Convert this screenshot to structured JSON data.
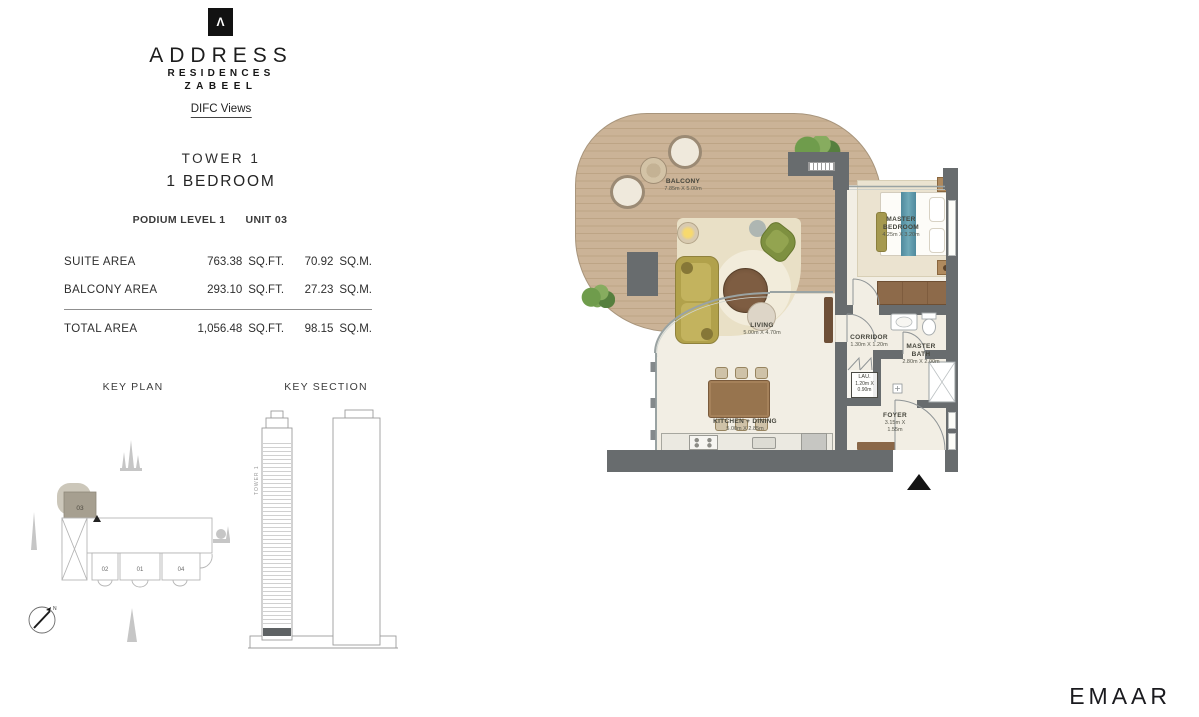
{
  "brand": {
    "logo_mark_glyph": "Λ",
    "name": "ADDRESS",
    "sub_name": "RESIDENCES",
    "location": "ZABEEL",
    "view_tag": "DIFC Views"
  },
  "unit": {
    "tower": "TOWER 1",
    "bedrooms": "1 BEDROOM",
    "level": "PODIUM LEVEL 1",
    "unit_no": "UNIT 03"
  },
  "area_table": {
    "rows": [
      {
        "label": "SUITE AREA",
        "sqft": "763.38",
        "sqft_unit": "SQ.FT.",
        "sqm": "70.92",
        "sqm_unit": "SQ.M."
      },
      {
        "label": "BALCONY AREA",
        "sqft": "293.10",
        "sqft_unit": "SQ.FT.",
        "sqm": "27.23",
        "sqm_unit": "SQ.M."
      },
      {
        "label": "TOTAL AREA",
        "sqft": "1,056.48",
        "sqft_unit": "SQ.FT.",
        "sqm": "98.15",
        "sqm_unit": "SQ.M."
      }
    ]
  },
  "key_plan": {
    "title": "KEY PLAN",
    "highlighted_unit": "03",
    "units": [
      "02",
      "01",
      "04"
    ],
    "compass_letter": "N"
  },
  "key_section": {
    "title": "KEY SECTION",
    "tower_label": "TOWER 1"
  },
  "floor_plan": {
    "rooms": [
      {
        "name": "BALCONY",
        "dims": "7.85m X 5.00m"
      },
      {
        "name": "LIVING",
        "dims": "5.00m X 4.70m"
      },
      {
        "name": "MASTER BEDROOM",
        "dims": "4.25m X 3.20m"
      },
      {
        "name": "CORRIDOR",
        "dims": "1.30m X 1.20m"
      },
      {
        "name": "MASTER BATH",
        "dims": "2.80m X 2.00m"
      },
      {
        "name": "LAU.",
        "dims": "1.20m X 0.90m"
      },
      {
        "name": "KITCHEN + DINING",
        "dims": "5.00m X 2.85m"
      },
      {
        "name": "FOYER",
        "dims": "3.15m X 1.55m"
      }
    ]
  },
  "footer": {
    "developer": "EMAAR"
  },
  "colors": {
    "wall": "#686c6e",
    "deck_wood": "#c8b094",
    "floor": "#f2eee4",
    "sofa_olive": "#b2a24c",
    "bed_runner_teal": "#5e9cab",
    "unit_highlight": "#a69f90"
  }
}
